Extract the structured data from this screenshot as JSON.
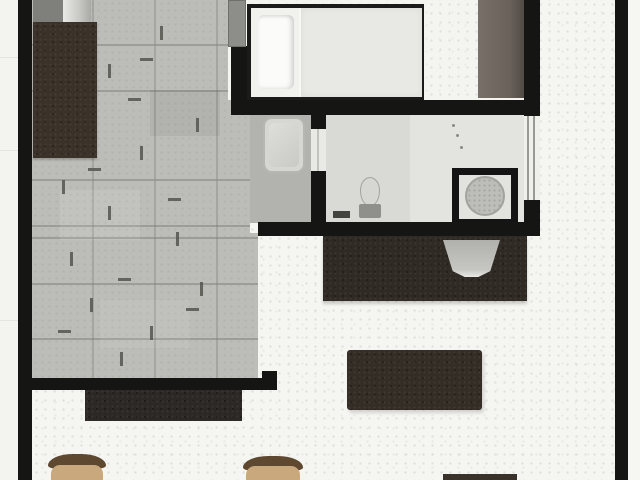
{
  "meta": {
    "title": "Apartment floor plan (top-down render, no text labels)",
    "view": "top-down",
    "cropped_edges": [
      "top",
      "bottom"
    ]
  },
  "palette": {
    "wall": "#151513",
    "outside": "#f3f3f0",
    "living_floor": "#f5f5f2",
    "bedroom_floor": "#f4f4f1",
    "tile_floor": "#bcbcb8",
    "bathroom_floor": "#d9d9d6",
    "niche_floor": "#b2b2af",
    "door_leaf": "#8d8d89",
    "hall_wardrobe": "#3a3229",
    "bedroom_wardrobe": "#6e6660",
    "bed_frame": "#1b1b19",
    "bed_sheet": "#f1f1ee",
    "bed_blanket": "#e8e8e5",
    "pillow": "#fbfbf9",
    "washer": "#d6d6d3",
    "toilet_bowl": "#d6d6d3",
    "toilet_tank": "#8f8f8b",
    "shower_frame": "#141414",
    "shower_floor": "#e2e2df",
    "shower_tray": "#bdbdba",
    "kitchen_counter": "#2f2a24",
    "sink": "#b9b9b6",
    "dining_table": "#332d26",
    "sideboard": "#2b2825",
    "chair_back": "#5e4830",
    "chair_seat": "#c8a87c",
    "appliance_dark": "#7f7f7c",
    "appliance_light": "#c7c7c4",
    "partial_furniture": "#38322b"
  },
  "rooms": [
    {
      "name": "hallway",
      "floor": "stone tile"
    },
    {
      "name": "bedroom",
      "floor": "light speckled"
    },
    {
      "name": "bathroom",
      "floor": "light grey"
    },
    {
      "name": "laundry-niche",
      "floor": "grey"
    },
    {
      "name": "living-room-kitchen",
      "floor": "light speckled"
    },
    {
      "name": "entry-strip",
      "floor": "light speckled"
    }
  ],
  "furniture": [
    {
      "name": "double-bed",
      "room": "bedroom"
    },
    {
      "name": "pillow",
      "room": "bedroom"
    },
    {
      "name": "wardrobe",
      "room": "bedroom"
    },
    {
      "name": "wardrobe",
      "room": "hallway"
    },
    {
      "name": "appliance-pair",
      "room": "hallway"
    },
    {
      "name": "washing-machine",
      "room": "laundry-niche"
    },
    {
      "name": "toilet",
      "room": "bathroom"
    },
    {
      "name": "shower-cabin",
      "room": "bathroom"
    },
    {
      "name": "kitchen-counter",
      "room": "living-room-kitchen"
    },
    {
      "name": "kitchen-sink",
      "room": "living-room-kitchen"
    },
    {
      "name": "dining-table",
      "room": "living-room-kitchen"
    },
    {
      "name": "sideboard",
      "room": "living-room-kitchen"
    },
    {
      "name": "chair",
      "room": "living-room-kitchen"
    },
    {
      "name": "chair",
      "room": "living-room-kitchen"
    },
    {
      "name": "partial-furniture",
      "room": "living-room-kitchen"
    }
  ],
  "openings": [
    {
      "name": "bedroom-door",
      "between": [
        "hallway",
        "bedroom"
      ]
    },
    {
      "name": "bathroom-inner-door",
      "between": [
        "laundry-niche",
        "bathroom"
      ]
    },
    {
      "name": "bathroom-door-window",
      "between": [
        "bathroom",
        "entry-strip"
      ]
    }
  ]
}
